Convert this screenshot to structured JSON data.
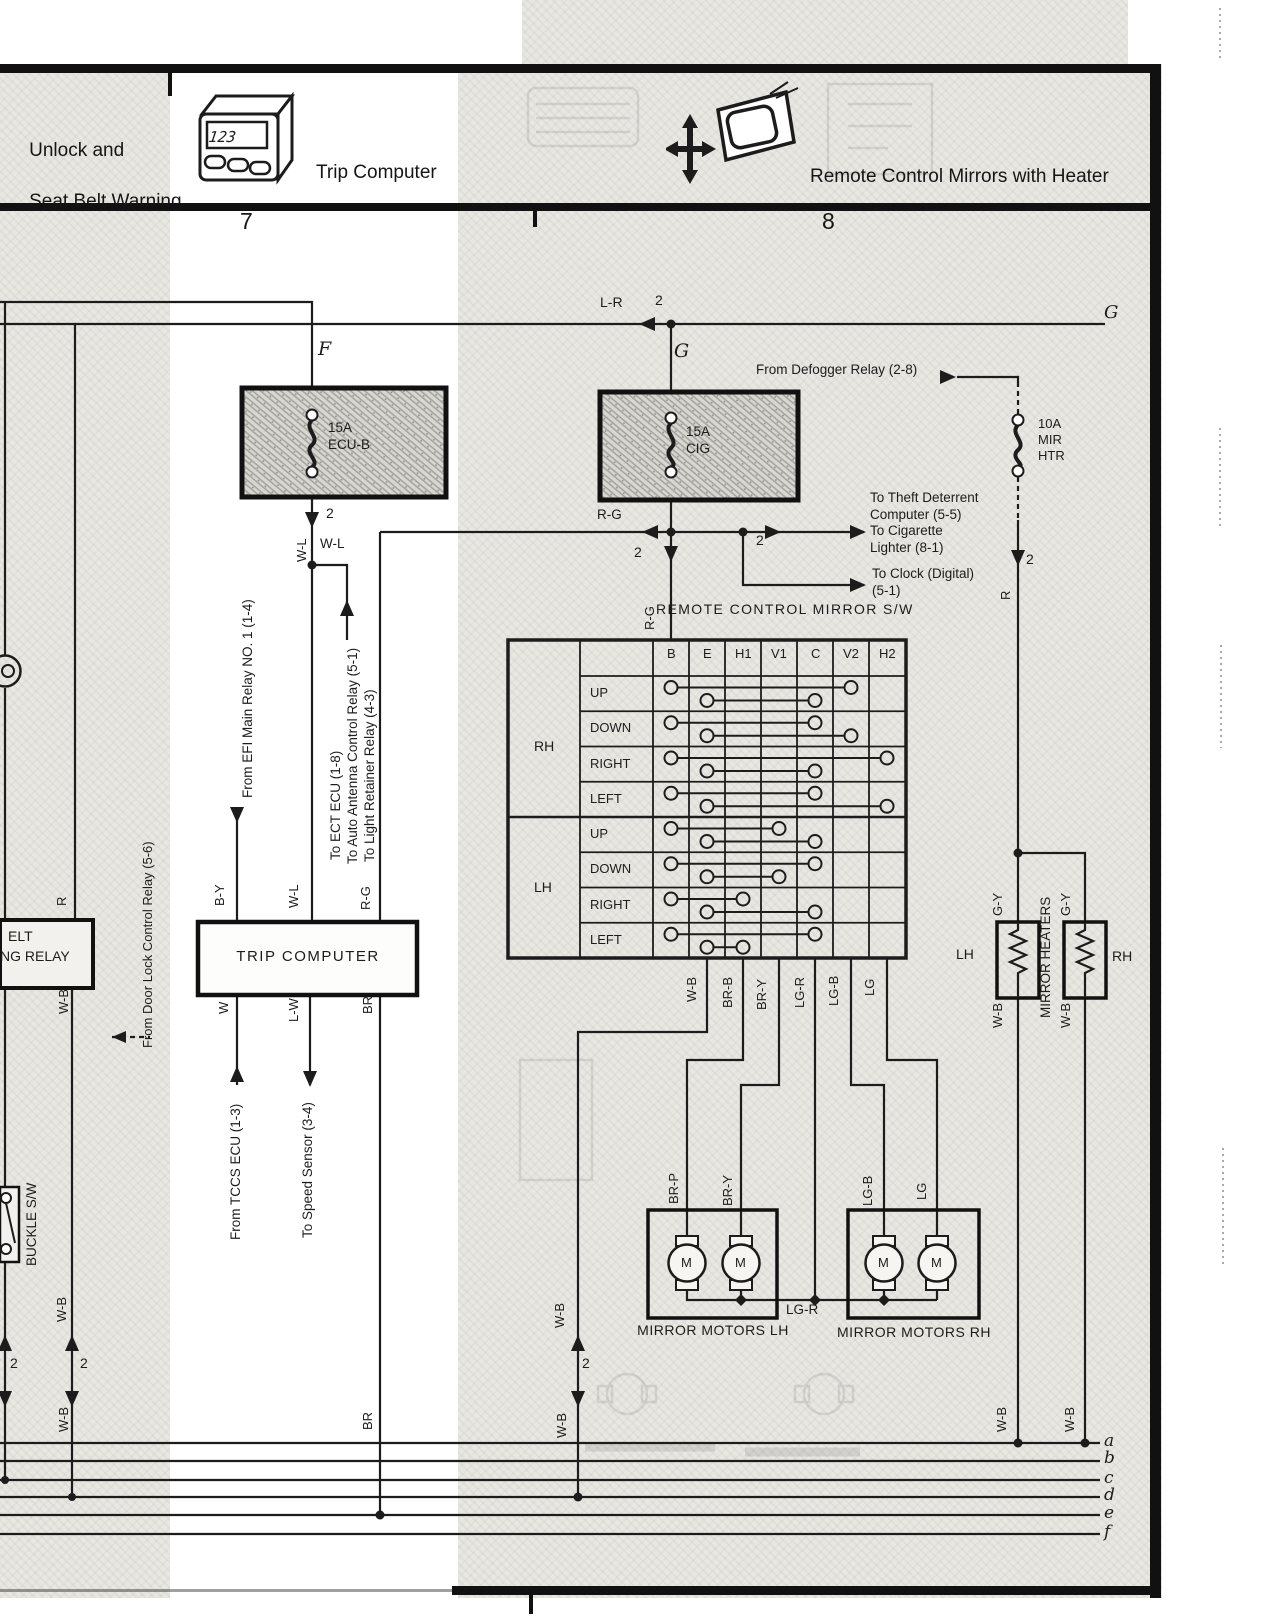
{
  "colors": {
    "ink": "#1c1c1c",
    "paper_gray": "#e9e7e2",
    "accent": "#000000"
  },
  "header": {
    "unlock_line1": "Unlock and",
    "unlock_line2": "Seat Belt Warning",
    "trip_label": "Trip Computer",
    "trip_icon_display": "123",
    "mirror_label": "Remote Control Mirrors with Heater",
    "col_left": "7",
    "col_right": "8"
  },
  "trip_computer": {
    "label": "TRIP COMPUTER"
  },
  "motors": {
    "lh": "MIRROR MOTORS LH",
    "rh": "MIRROR MOTORS RH"
  },
  "mirror_switch": {
    "title": "REMOTE CONTROL MIRROR S/W",
    "columns": [
      "B",
      "E",
      "H1",
      "V1",
      "C",
      "V2",
      "H2"
    ],
    "groups": [
      {
        "name": "RH",
        "rows": [
          {
            "label": "UP",
            "upper": [
              "B",
              "V2"
            ],
            "lower": [
              "E",
              "C"
            ]
          },
          {
            "label": "DOWN",
            "upper": [
              "B",
              "C"
            ],
            "lower": [
              "E",
              "V2"
            ]
          },
          {
            "label": "RIGHT",
            "upper": [
              "B",
              "H2"
            ],
            "lower": [
              "E",
              "C"
            ]
          },
          {
            "label": "LEFT",
            "upper": [
              "B",
              "C"
            ],
            "lower": [
              "E",
              "H2"
            ]
          }
        ]
      },
      {
        "name": "LH",
        "rows": [
          {
            "label": "UP",
            "upper": [
              "B",
              "V1"
            ],
            "lower": [
              "E",
              "C"
            ]
          },
          {
            "label": "DOWN",
            "upper": [
              "B",
              "C"
            ],
            "lower": [
              "E",
              "V1"
            ]
          },
          {
            "label": "RIGHT",
            "upper": [
              "B",
              "H1"
            ],
            "lower": [
              "E",
              "C"
            ]
          },
          {
            "label": "LEFT",
            "upper": [
              "B",
              "C"
            ],
            "lower": [
              "E",
              "H1"
            ]
          }
        ]
      }
    ]
  },
  "labels": [
    {
      "n": "wire-label-lr",
      "t": "L-R",
      "x": 600,
      "y": 294,
      "s": 14
    },
    {
      "n": "qty-2-lr",
      "t": "2",
      "x": 655,
      "y": 292,
      "s": 14
    },
    {
      "n": "node-g-right",
      "t": "G",
      "x": 1104,
      "y": 302,
      "s": 18,
      "c": "ser"
    },
    {
      "n": "node-f",
      "t": "F",
      "x": 318,
      "y": 338,
      "s": 19,
      "c": "ser"
    },
    {
      "n": "node-g",
      "t": "G",
      "x": 674,
      "y": 340,
      "s": 19,
      "c": "ser"
    },
    {
      "n": "note-defogger",
      "t": "From Defogger Relay (2-8)",
      "x": 756,
      "y": 362,
      "s": 13.5
    },
    {
      "n": "fuse-ecu-b-label",
      "t": "15A\nECU-B",
      "x": 328,
      "y": 420,
      "s": 13.5
    },
    {
      "n": "fuse-cig-label",
      "t": "15A\nCIG",
      "x": 686,
      "y": 424,
      "s": 13.5
    },
    {
      "n": "fuse-mir-htr-label",
      "t": "10A\nMIR\nHTR",
      "x": 1038,
      "y": 416,
      "s": 13
    },
    {
      "n": "qty-2-ecub",
      "t": "2",
      "x": 326,
      "y": 505,
      "s": 14
    },
    {
      "n": "wire-label-wl-rot",
      "t": "W-L",
      "x": 294,
      "y": 562,
      "r": 1,
      "s": 13
    },
    {
      "n": "wire-label-wl-h",
      "t": "W-L",
      "x": 320,
      "y": 536,
      "s": 13.5
    },
    {
      "n": "wire-label-rg-h",
      "t": "R-G",
      "x": 597,
      "y": 507,
      "s": 13.5
    },
    {
      "n": "qty-2-rg-down",
      "t": "2",
      "x": 634,
      "y": 544,
      "s": 14
    },
    {
      "n": "qty-2-rg-right",
      "t": "2",
      "x": 756,
      "y": 532,
      "s": 14
    },
    {
      "n": "note-theft",
      "t": "To Theft Deterrent\nComputer (5-5)\nTo Cigarette\nLighter (8-1)",
      "x": 870,
      "y": 490,
      "s": 13.5
    },
    {
      "n": "note-clock",
      "t": "To Clock (Digital)\n(5-1)",
      "x": 872,
      "y": 566,
      "s": 13.5
    },
    {
      "n": "qty-2-mir",
      "t": "2",
      "x": 1026,
      "y": 551,
      "s": 14
    },
    {
      "n": "wire-label-r-mir",
      "t": "R",
      "x": 998,
      "y": 600,
      "r": 1,
      "s": 13
    },
    {
      "n": "switch-title",
      "t": "REMOTE CONTROL MIRROR S/W",
      "x": 656,
      "y": 601,
      "s": 14,
      "ls": 1.4
    },
    {
      "n": "wire-label-rg-table",
      "t": "R-G",
      "x": 642,
      "y": 630,
      "r": 1,
      "s": 13
    },
    {
      "n": "note-efi",
      "t": "From EFI Main Relay NO. 1 (1-4)",
      "x": 240,
      "y": 798,
      "r": 1,
      "s": 13.5
    },
    {
      "n": "note-ect",
      "t": "To ECT ECU (1-8)",
      "x": 328,
      "y": 860,
      "r": 1,
      "s": 13.5
    },
    {
      "n": "note-antenna",
      "t": "To Auto Antenna Control Relay (5-1)",
      "x": 345,
      "y": 864,
      "r": 1,
      "s": 13.5
    },
    {
      "n": "note-light",
      "t": "To Light Retainer Relay (4-3)",
      "x": 362,
      "y": 862,
      "r": 1,
      "s": 13.5
    },
    {
      "n": "wire-label-by",
      "t": "B-Y",
      "x": 212,
      "y": 906,
      "r": 1,
      "s": 13
    },
    {
      "n": "wire-label-wl2",
      "t": "W-L",
      "x": 286,
      "y": 908,
      "r": 1,
      "s": 13
    },
    {
      "n": "wire-label-rg2",
      "t": "R-G",
      "x": 358,
      "y": 910,
      "r": 1,
      "s": 13
    },
    {
      "n": "wire-label-w",
      "t": "W",
      "x": 216,
      "y": 1014,
      "r": 1,
      "s": 13
    },
    {
      "n": "wire-label-lw",
      "t": "L-W",
      "x": 286,
      "y": 1022,
      "r": 1,
      "s": 13
    },
    {
      "n": "wire-label-br",
      "t": "BR",
      "x": 360,
      "y": 1014,
      "r": 1,
      "s": 13
    },
    {
      "n": "note-tccs",
      "t": "From TCCS ECU (1-3)",
      "x": 228,
      "y": 1240,
      "r": 1,
      "s": 13.5
    },
    {
      "n": "note-speed",
      "t": "To Speed Sensor (3-4)",
      "x": 300,
      "y": 1238,
      "r": 1,
      "s": 13.5
    },
    {
      "n": "note-doorlock",
      "t": "From Door Lock Control Relay (5-6)",
      "x": 140,
      "y": 1048,
      "r": 1,
      "s": 13
    },
    {
      "n": "wire-label-r-relay",
      "t": "R",
      "x": 54,
      "y": 906,
      "r": 1,
      "s": 13
    },
    {
      "n": "relay-label-line1",
      "t": "ELT",
      "x": 8,
      "y": 928,
      "s": 14
    },
    {
      "n": "relay-label-line2",
      "t": "NG RELAY",
      "x": 0,
      "y": 948,
      "s": 14
    },
    {
      "n": "wire-label-wb-relay",
      "t": "W-B",
      "x": 56,
      "y": 1014,
      "r": 1,
      "s": 13
    },
    {
      "n": "buckle-sw-label",
      "t": "BUCKLE S/W",
      "x": 24,
      "y": 1266,
      "r": 1,
      "s": 13.5
    },
    {
      "n": "wire-label-wb-l2",
      "t": "W-B",
      "x": 54,
      "y": 1322,
      "r": 1,
      "s": 13
    },
    {
      "n": "qty-2-left1",
      "t": "2",
      "x": 10,
      "y": 1355,
      "s": 14
    },
    {
      "n": "qty-2-left2",
      "t": "2",
      "x": 80,
      "y": 1355,
      "s": 14
    },
    {
      "n": "wire-label-wb-l3",
      "t": "W-B",
      "x": 56,
      "y": 1432,
      "r": 1,
      "s": 13
    },
    {
      "n": "wire-label-wb-e",
      "t": "W-B",
      "x": 684,
      "y": 1002,
      "r": 1,
      "s": 13
    },
    {
      "n": "wire-label-brb",
      "t": "BR-B",
      "x": 720,
      "y": 1008,
      "r": 1,
      "s": 13
    },
    {
      "n": "wire-label-bry",
      "t": "BR-Y",
      "x": 754,
      "y": 1010,
      "r": 1,
      "s": 13
    },
    {
      "n": "wire-label-lgr",
      "t": "LG-R",
      "x": 792,
      "y": 1008,
      "r": 1,
      "s": 13
    },
    {
      "n": "wire-label-lgb",
      "t": "LG-B",
      "x": 826,
      "y": 1006,
      "r": 1,
      "s": 13
    },
    {
      "n": "wire-label-lg",
      "t": "LG",
      "x": 862,
      "y": 996,
      "r": 1,
      "s": 13
    },
    {
      "n": "wire-label-brp-m",
      "t": "BR-P",
      "x": 666,
      "y": 1204,
      "r": 1,
      "s": 13
    },
    {
      "n": "wire-label-bry-m",
      "t": "BR-Y",
      "x": 720,
      "y": 1206,
      "r": 1,
      "s": 13
    },
    {
      "n": "wire-label-lgb-m",
      "t": "LG-B",
      "x": 860,
      "y": 1206,
      "r": 1,
      "s": 13
    },
    {
      "n": "wire-label-lg-m",
      "t": "LG",
      "x": 914,
      "y": 1200,
      "r": 1,
      "s": 13
    },
    {
      "n": "wire-label-wb-mid1",
      "t": "W-B",
      "x": 552,
      "y": 1328,
      "r": 1,
      "s": 13
    },
    {
      "n": "qty-2-mid",
      "t": "2",
      "x": 582,
      "y": 1355,
      "s": 14
    },
    {
      "n": "wire-label-wb-mid2",
      "t": "W-B",
      "x": 554,
      "y": 1438,
      "r": 1,
      "s": 13
    },
    {
      "n": "wire-label-lgr-h",
      "t": "LG-R",
      "x": 786,
      "y": 1302,
      "s": 13.5
    },
    {
      "n": "wire-label-br-bot",
      "t": "BR",
      "x": 360,
      "y": 1430,
      "r": 1,
      "s": 13
    },
    {
      "n": "wire-label-gy-lh",
      "t": "G-Y",
      "x": 990,
      "y": 916,
      "r": 1,
      "s": 13
    },
    {
      "n": "wire-label-gy-rh",
      "t": "G-Y",
      "x": 1058,
      "y": 916,
      "r": 1,
      "s": 13
    },
    {
      "n": "heaters-title",
      "t": "MIRROR HEATERS",
      "x": 1038,
      "y": 1018,
      "r": 1,
      "s": 13.5
    },
    {
      "n": "heater-lh-label",
      "t": "LH",
      "x": 956,
      "y": 946,
      "s": 14
    },
    {
      "n": "heater-rh-label",
      "t": "RH",
      "x": 1112,
      "y": 948,
      "s": 14
    },
    {
      "n": "wire-label-wb-hlh",
      "t": "W-B",
      "x": 990,
      "y": 1028,
      "r": 1,
      "s": 13
    },
    {
      "n": "wire-label-wb-hrh",
      "t": "W-B",
      "x": 1058,
      "y": 1028,
      "r": 1,
      "s": 13
    },
    {
      "n": "wire-label-wb-blh",
      "t": "W-B",
      "x": 994,
      "y": 1432,
      "r": 1,
      "s": 13
    },
    {
      "n": "wire-label-wb-brh",
      "t": "W-B",
      "x": 1062,
      "y": 1432,
      "r": 1,
      "s": 13
    },
    {
      "n": "motor-m-1",
      "t": "M",
      "x": 681,
      "y": 1255,
      "s": 13
    },
    {
      "n": "motor-m-2",
      "t": "M",
      "x": 735,
      "y": 1255,
      "s": 13
    },
    {
      "n": "motor-m-3",
      "t": "M",
      "x": 878,
      "y": 1255,
      "s": 13
    },
    {
      "n": "motor-m-4",
      "t": "M",
      "x": 931,
      "y": 1255,
      "s": 13
    },
    {
      "n": "bus-letter-a",
      "t": "a",
      "x": 1104,
      "y": 1431,
      "s": 17,
      "c": "ser"
    },
    {
      "n": "bus-letter-b",
      "t": "b",
      "x": 1104,
      "y": 1448,
      "s": 17,
      "c": "ser"
    },
    {
      "n": "bus-letter-c",
      "t": "c",
      "x": 1104,
      "y": 1468,
      "s": 17,
      "c": "ser"
    },
    {
      "n": "bus-letter-d",
      "t": "d",
      "x": 1104,
      "y": 1485,
      "s": 17,
      "c": "ser"
    },
    {
      "n": "bus-letter-e",
      "t": "e",
      "x": 1104,
      "y": 1503,
      "s": 17,
      "c": "ser"
    },
    {
      "n": "bus-letter-f",
      "t": "f",
      "x": 1104,
      "y": 1522,
      "s": 17,
      "c": "ser"
    }
  ]
}
